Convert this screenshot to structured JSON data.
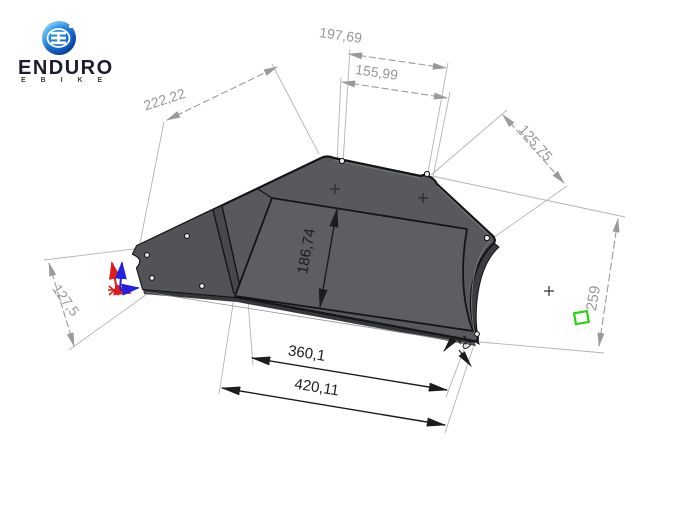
{
  "logo": {
    "brand": "ENDURO",
    "sub": "E B I K E"
  },
  "drawing": {
    "dimensions": {
      "top_left_edge": "222,22",
      "top_outer": "197,69",
      "top_inner": "155,99",
      "right_upper": "125,75",
      "inner_height": "186,74",
      "left_tip": "127,5",
      "right_height": "259",
      "bottom_inner": "360,1",
      "bottom_outer": "420,11",
      "thickness": "10"
    },
    "colors": {
      "part_gray": "#57595c",
      "part_floor": "#5c5e61",
      "part_flap": "#515356",
      "part_edge_face": "#3b3d40",
      "outline": "#141517",
      "dim_gray": "#9a9a9a",
      "dim_black": "#1c1c1c",
      "axis_red": "#e01b1b",
      "axis_blue": "#2222dd",
      "selection_green": "#2ad40e",
      "logo_blue_top": "#45c8f2",
      "logo_blue_bottom": "#0a4fc0",
      "brand_navy": "#1b1b32"
    }
  }
}
